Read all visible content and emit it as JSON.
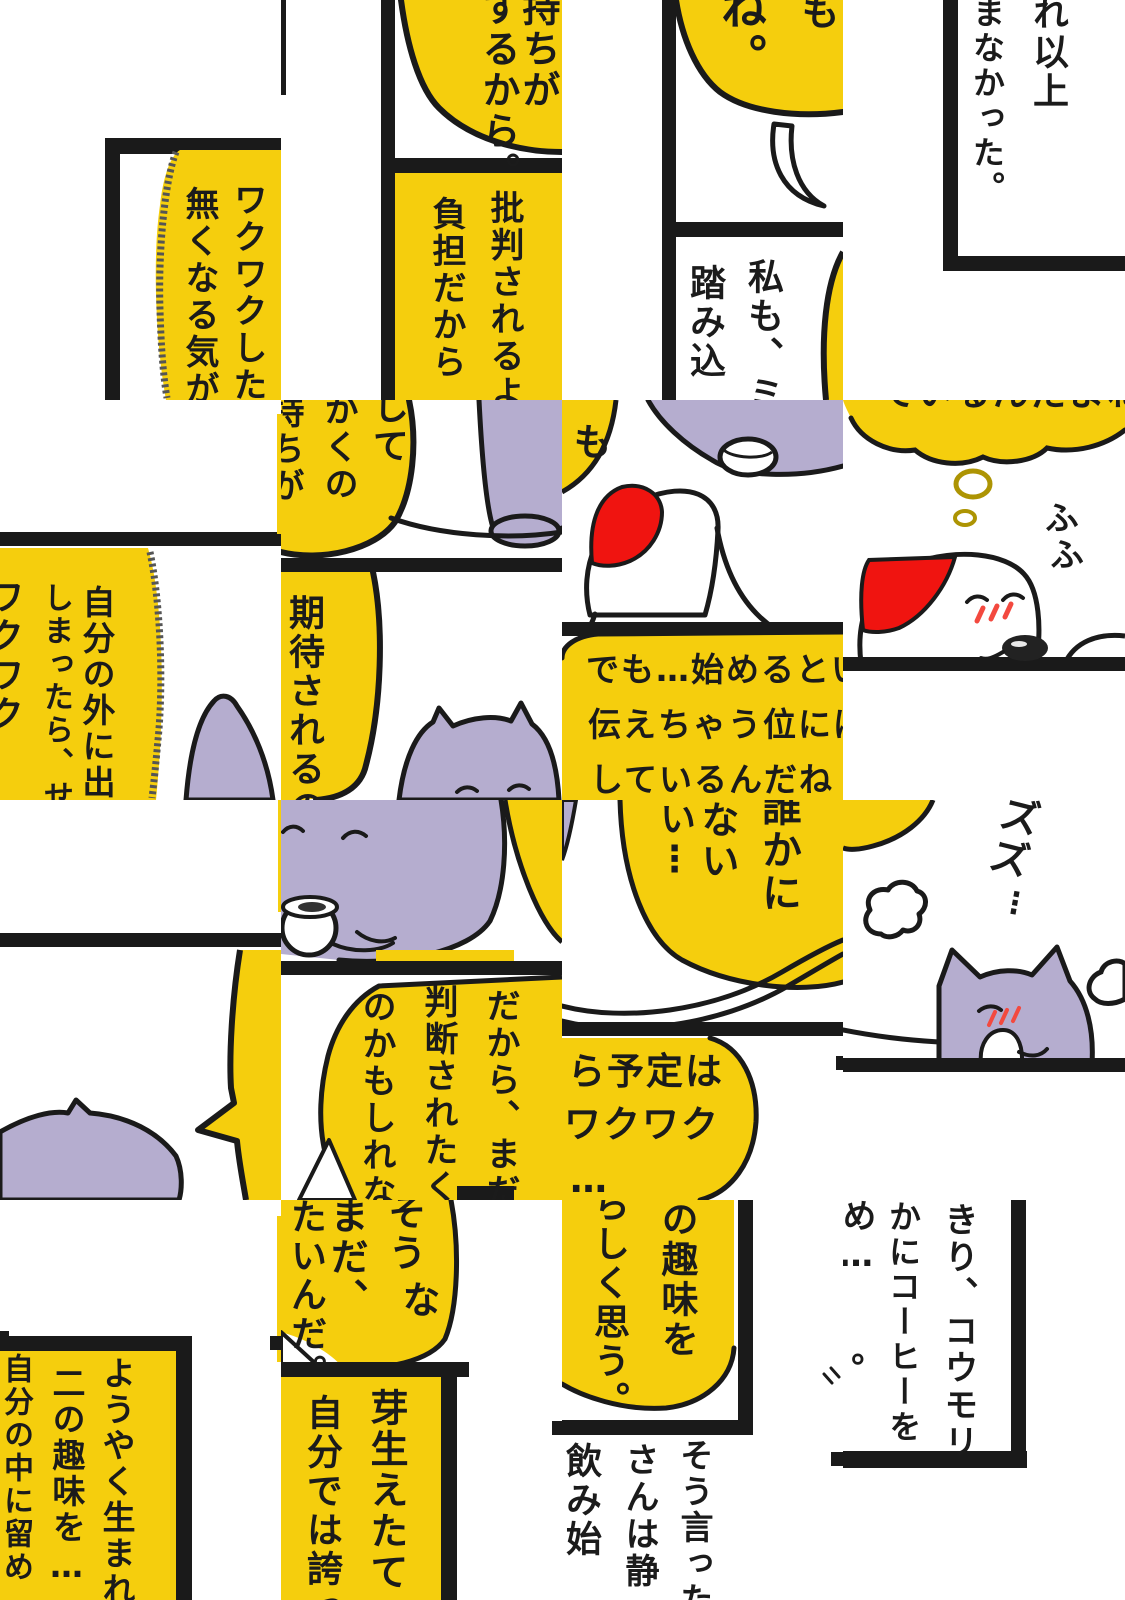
{
  "page": {
    "kind": "scrambled comic page",
    "grid_rows": 4,
    "grid_cols": 4
  },
  "colors": {
    "bubble_yellow": "#F5CE0D",
    "cat_purple": "#B5ADCF",
    "hat_red": "#F01410",
    "blush_red": "#F3493F",
    "outline_black": "#1A1A1A",
    "thought_outline": "#AD9403"
  },
  "tiles": {
    "r0c0": {
      "texts": [
        "ワクワクした",
        "無くなる気が"
      ]
    },
    "r0c1": {
      "texts": [
        "持ちが",
        "するから。",
        "批判されるよ",
        "負担だから"
      ]
    },
    "r0c2": {
      "texts": [
        "ね。",
        "も",
        "私も、ミ",
        "踏み込"
      ]
    },
    "r0c3": {
      "texts": [
        "れ以上",
        "まなかった。"
      ]
    },
    "r1c0": {
      "texts": [
        "自分の外に出",
        "しまったら、せ",
        "ワクワク"
      ]
    },
    "r1c1": {
      "texts": [
        "して",
        "かくの",
        "持ちが",
        "期待されるの"
      ]
    },
    "r1c2": {
      "texts": [
        "も",
        "でも…始めるとい",
        "伝えちゃう位には",
        "しているんだね"
      ]
    },
    "r1c3": {
      "texts": [
        "ているんだよね",
        "ふふ"
      ]
    },
    "r2c0": {
      "texts": []
    },
    "r2c1": {
      "texts": [
        "だから、まだ誰",
        "判断されたく",
        "のかもしれな"
      ]
    },
    "r2c2": {
      "texts": [
        "誰かに",
        "ない",
        "い⋮",
        "ら予定は",
        "ワクワク",
        "…"
      ]
    },
    "r2c3": {
      "texts": [
        "ズズ",
        "⋮"
      ]
    },
    "r3c0": {
      "texts": [
        "ようやく生まれ",
        "二の趣味を…",
        "自分の中に留め"
      ]
    },
    "r3c1": {
      "texts": [
        "そう",
        "な",
        "まだ、",
        "たいんだ。",
        "芽生えたて",
        "自分では誇っ"
      ]
    },
    "r3c2": {
      "texts": [
        "の趣味を",
        "らしく思う。",
        "そう言った",
        "さんは静",
        "飲み始"
      ]
    },
    "r3c3": {
      "texts": [
        "きり、コウモリ",
        "かにコーヒーを",
        "め…",
        "。"
      ]
    }
  }
}
